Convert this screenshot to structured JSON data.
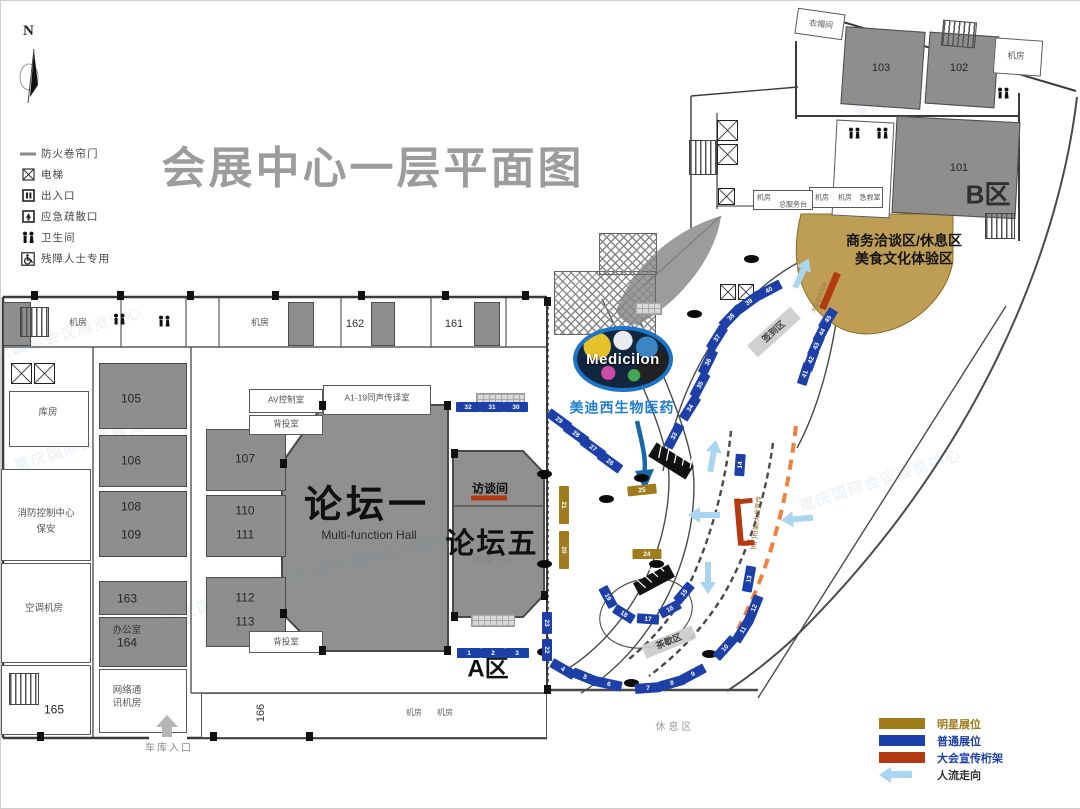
{
  "title": "会展中心一层平面图",
  "compass": {
    "label": "N"
  },
  "legend_top": {
    "items": [
      {
        "icon": "fire-shutter-icon",
        "label": "防火卷帘门"
      },
      {
        "icon": "elevator-icon",
        "label": "电梯"
      },
      {
        "icon": "entrance-icon",
        "label": "出入口"
      },
      {
        "icon": "emergency-exit-icon",
        "label": "应急疏散口"
      },
      {
        "icon": "restroom-icon",
        "label": "卫生间"
      },
      {
        "icon": "wheelchair-icon",
        "label": "残障人士专用"
      }
    ]
  },
  "legend_bottom": {
    "items": [
      {
        "type": "swatch",
        "color": "#a17c1c",
        "label": "明星展位",
        "label_color": "#a17c1c"
      },
      {
        "type": "swatch",
        "color": "#1c3fa8",
        "label": "普通展位",
        "label_color": "#1c3fa8"
      },
      {
        "type": "swatch",
        "color": "#b33a10",
        "label": "大会宣传桁架",
        "label_color": "#1c3fa8"
      },
      {
        "type": "arrow",
        "color": "#a9d5f1",
        "label": "人流走向",
        "label_color": "#333333"
      }
    ]
  },
  "halls": {
    "forum1": {
      "label": "论坛一",
      "en": "Multi-function Hall"
    },
    "forum5": {
      "label": "论坛五",
      "sub": "新闻中心"
    },
    "interview": {
      "label": "访谈间"
    },
    "zoneA": {
      "label": "A区"
    },
    "zoneB": {
      "label": "B区"
    }
  },
  "medicilon": {
    "logo": "Medicilon",
    "company": "美迪西生物医药"
  },
  "areas": {
    "business_line1": "商务洽谈区/休息区",
    "business_line2": "美食文化体验区",
    "checkin": "签到区",
    "teabreak": "茶歇区",
    "rest": "休息区",
    "garage": "车库入口",
    "truss_note": "拱门桁架/大会宣传",
    "truss_note2": "大会宣传桁架"
  },
  "watermark_text": "重庆国际会议展览中心",
  "colors": {
    "booth_normal": "#1c3fa8",
    "booth_star": "#a17c1c",
    "truss": "#b33a10",
    "flow": "#a9d5f1",
    "tan_area": "#be9d55",
    "hall_fill": "#909090",
    "title": "#9c9c9c",
    "orange_dash": "#f08040"
  },
  "labels": [
    {
      "t": "机房",
      "x": 77,
      "y": 322,
      "s": 9,
      "c": "#555"
    },
    {
      "t": "机房",
      "x": 259,
      "y": 322,
      "s": 9,
      "c": "#555"
    },
    {
      "t": "162",
      "x": 354,
      "y": 324,
      "s": 11,
      "c": "#333"
    },
    {
      "t": "161",
      "x": 453,
      "y": 324,
      "s": 11,
      "c": "#333"
    },
    {
      "t": "库房",
      "x": 47,
      "y": 412,
      "s": 9.5,
      "c": "#555"
    },
    {
      "t": "105",
      "x": 130,
      "y": 398,
      "s": 12,
      "c": "#262626"
    },
    {
      "t": "106",
      "x": 130,
      "y": 460,
      "s": 12,
      "c": "#262626"
    },
    {
      "t": "108",
      "x": 130,
      "y": 506,
      "s": 12,
      "c": "#262626"
    },
    {
      "t": "109",
      "x": 130,
      "y": 534,
      "s": 12,
      "c": "#262626"
    },
    {
      "t": "107",
      "x": 244,
      "y": 458,
      "s": 12,
      "c": "#262626"
    },
    {
      "t": "110",
      "x": 244,
      "y": 510,
      "s": 12,
      "c": "#262626"
    },
    {
      "t": "111",
      "x": 244,
      "y": 534,
      "s": 12,
      "c": "#262626"
    },
    {
      "t": "112",
      "x": 244,
      "y": 597,
      "s": 12,
      "c": "#262626"
    },
    {
      "t": "113",
      "x": 244,
      "y": 621,
      "s": 12,
      "c": "#262626"
    },
    {
      "t": "消防控制中心",
      "x": 45,
      "y": 513,
      "s": 9.5,
      "c": "#555"
    },
    {
      "t": "保安",
      "x": 45,
      "y": 529,
      "s": 9.5,
      "c": "#555"
    },
    {
      "t": "空调机房",
      "x": 43,
      "y": 608,
      "s": 9.5,
      "c": "#555"
    },
    {
      "t": "163",
      "x": 126,
      "y": 598,
      "s": 12,
      "c": "#262626"
    },
    {
      "t": "办公室",
      "x": 126,
      "y": 630,
      "s": 9.5,
      "c": "#333"
    },
    {
      "t": "164",
      "x": 126,
      "y": 642,
      "s": 12,
      "c": "#262626"
    },
    {
      "t": "网络通",
      "x": 126,
      "y": 690,
      "s": 9.5,
      "c": "#555"
    },
    {
      "t": "讯机房",
      "x": 126,
      "y": 703,
      "s": 9.5,
      "c": "#555"
    },
    {
      "t": "165",
      "x": 53,
      "y": 709,
      "s": 12,
      "c": "#262626"
    },
    {
      "t": "166",
      "x": 261,
      "y": 712,
      "s": 11,
      "c": "#333",
      "r": -90
    },
    {
      "t": "机房",
      "x": 413,
      "y": 712,
      "s": 8,
      "c": "#666"
    },
    {
      "t": "机房",
      "x": 444,
      "y": 712,
      "s": 8,
      "c": "#666"
    },
    {
      "t": "车库入口",
      "x": 168,
      "y": 748,
      "s": 10,
      "c": "#8a8a8a",
      "ls": 2,
      "n": "garage-entrance-label"
    },
    {
      "t": "AV控制室",
      "x": 285,
      "y": 399,
      "s": 8.5,
      "c": "#555"
    },
    {
      "t": "A1-19同声传译室",
      "x": 376,
      "y": 397,
      "s": 8.5,
      "c": "#555"
    },
    {
      "t": "背投室",
      "x": 285,
      "y": 423,
      "s": 8.5,
      "c": "#555"
    },
    {
      "t": "背投室",
      "x": 285,
      "y": 641,
      "s": 8.5,
      "c": "#555"
    },
    {
      "t": "衣帽间",
      "x": 820,
      "y": 24,
      "s": 8,
      "c": "#555",
      "r": 6
    },
    {
      "t": "103",
      "x": 880,
      "y": 68,
      "s": 11,
      "c": "#262626"
    },
    {
      "t": "102",
      "x": 958,
      "y": 68,
      "s": 11,
      "c": "#262626"
    },
    {
      "t": "机房",
      "x": 1015,
      "y": 55,
      "s": 8.5,
      "c": "#555"
    },
    {
      "t": "101",
      "x": 958,
      "y": 168,
      "s": 11,
      "c": "#262626"
    },
    {
      "t": "机房",
      "x": 763,
      "y": 197,
      "s": 7,
      "c": "#555"
    },
    {
      "t": "总服务台",
      "x": 792,
      "y": 204,
      "s": 7,
      "c": "#555"
    },
    {
      "t": "机房",
      "x": 821,
      "y": 197,
      "s": 7,
      "c": "#555"
    },
    {
      "t": "机房",
      "x": 844,
      "y": 197,
      "s": 7,
      "c": "#555"
    },
    {
      "t": "急救室",
      "x": 869,
      "y": 197,
      "s": 7,
      "c": "#555"
    },
    {
      "t": "休息区",
      "x": 674,
      "y": 727,
      "s": 10,
      "c": "#9a9a9a",
      "ls": 3,
      "n": "rest-area-label"
    },
    {
      "t": "签到区",
      "x": 773,
      "y": 331,
      "s": 9,
      "c": "#444",
      "r": -42,
      "b": 1,
      "n": "checkin-area-label"
    },
    {
      "t": "茶歇区",
      "x": 668,
      "y": 641,
      "s": 9,
      "c": "#444",
      "r": -22,
      "b": 1,
      "n": "teabreak-area-label"
    },
    {
      "t": "商务洽谈区/休息区",
      "x": 903,
      "y": 240,
      "s": 14,
      "c": "#141414",
      "b": 1,
      "n": "business-area-label"
    },
    {
      "t": "美食文化体验区",
      "x": 903,
      "y": 258,
      "s": 14,
      "c": "#141414",
      "b": 1,
      "n": "food-area-label"
    },
    {
      "t": "美迪西生物医药",
      "x": 621,
      "y": 407,
      "s": 14,
      "c": "#1f7ed0",
      "b": 1,
      "ls": 1,
      "n": "medicilon-company-label"
    },
    {
      "t": "拱门桁架/大会宣传",
      "x": 757,
      "y": 522,
      "s": 6.5,
      "c": "#8a5a2a",
      "r": -84,
      "n": "truss-note-label"
    },
    {
      "t": "大会宣传桁架",
      "x": 820,
      "y": 297,
      "s": 5.5,
      "c": "#997744",
      "r": -67,
      "n": "truss-note2-label"
    }
  ],
  "watermarks": [
    {
      "x": 95,
      "y": 440,
      "r": -18
    },
    {
      "x": 245,
      "y": 593,
      "r": -18
    },
    {
      "x": 400,
      "y": 551,
      "r": -12
    },
    {
      "x": 935,
      "y": 88,
      "r": -16
    },
    {
      "x": 60,
      "y": 335,
      "r": -16
    },
    {
      "x": 880,
      "y": 480,
      "r": -18
    }
  ],
  "booths": [
    {
      "n": 1,
      "x": 468,
      "y": 652,
      "r": 0,
      "t": "n",
      "w": 24
    },
    {
      "n": 2,
      "x": 492,
      "y": 652,
      "r": 0,
      "t": "n",
      "w": 24
    },
    {
      "n": 3,
      "x": 516,
      "y": 652,
      "r": 0,
      "t": "n",
      "w": 24
    },
    {
      "n": 4,
      "x": 562,
      "y": 668,
      "r": 30,
      "t": "n"
    },
    {
      "n": 5,
      "x": 584,
      "y": 676,
      "r": 22,
      "t": "n"
    },
    {
      "n": 6,
      "x": 608,
      "y": 683,
      "r": 12,
      "t": "n"
    },
    {
      "n": 7,
      "x": 647,
      "y": 687,
      "r": -4,
      "t": "n"
    },
    {
      "n": 8,
      "x": 671,
      "y": 682,
      "r": -16,
      "t": "n"
    },
    {
      "n": 9,
      "x": 692,
      "y": 673,
      "r": -28,
      "t": "n"
    },
    {
      "n": 10,
      "x": 724,
      "y": 647,
      "r": -48,
      "t": "n"
    },
    {
      "n": 11,
      "x": 742,
      "y": 629,
      "r": -58,
      "t": "n"
    },
    {
      "n": 12,
      "x": 753,
      "y": 607,
      "r": -68,
      "t": "n"
    },
    {
      "n": 13,
      "x": 748,
      "y": 578,
      "r": -80,
      "t": "n"
    },
    {
      "n": 14,
      "x": 739,
      "y": 464,
      "r": -86,
      "t": "n",
      "w": 22
    },
    {
      "n": 15,
      "x": 683,
      "y": 592,
      "r": -50,
      "t": "n",
      "w": 22
    },
    {
      "n": 16,
      "x": 669,
      "y": 608,
      "r": -28,
      "t": "n",
      "w": 22
    },
    {
      "n": 17,
      "x": 647,
      "y": 618,
      "r": 4,
      "t": "n",
      "w": 22
    },
    {
      "n": 18,
      "x": 623,
      "y": 613,
      "r": 32,
      "t": "n",
      "w": 22
    },
    {
      "n": 19,
      "x": 607,
      "y": 596,
      "r": 62,
      "t": "n",
      "w": 22
    },
    {
      "n": 20,
      "x": 563,
      "y": 549,
      "r": 90,
      "t": "s",
      "w": 38
    },
    {
      "n": 21,
      "x": 563,
      "y": 504,
      "r": 90,
      "t": "s",
      "w": 38
    },
    {
      "n": 22,
      "x": 546,
      "y": 649,
      "r": 90,
      "t": "n",
      "w": 22
    },
    {
      "n": 23,
      "x": 546,
      "y": 622,
      "r": 90,
      "t": "n",
      "w": 22
    },
    {
      "n": 24,
      "x": 646,
      "y": 553,
      "r": 0,
      "t": "s"
    },
    {
      "n": 25,
      "x": 641,
      "y": 489,
      "r": -6,
      "t": "s"
    },
    {
      "n": 26,
      "x": 609,
      "y": 461,
      "r": 36,
      "t": "n"
    },
    {
      "n": 27,
      "x": 592,
      "y": 447,
      "r": 36,
      "t": "n"
    },
    {
      "n": 28,
      "x": 575,
      "y": 433,
      "r": 36,
      "t": "n"
    },
    {
      "n": 29,
      "x": 558,
      "y": 419,
      "r": 36,
      "t": "n"
    },
    {
      "n": 30,
      "x": 515,
      "y": 406,
      "r": 0,
      "t": "n",
      "w": 24
    },
    {
      "n": 31,
      "x": 491,
      "y": 406,
      "r": 0,
      "t": "n",
      "w": 24
    },
    {
      "n": 32,
      "x": 467,
      "y": 406,
      "r": 0,
      "t": "n",
      "w": 24
    },
    {
      "n": 33,
      "x": 673,
      "y": 435,
      "r": -62,
      "t": "n"
    },
    {
      "n": 34,
      "x": 689,
      "y": 407,
      "r": -58,
      "t": "n"
    },
    {
      "n": 35,
      "x": 699,
      "y": 384,
      "r": -62,
      "t": "n"
    },
    {
      "n": 36,
      "x": 707,
      "y": 361,
      "r": -64,
      "t": "n"
    },
    {
      "n": 37,
      "x": 716,
      "y": 337,
      "r": -58,
      "t": "n"
    },
    {
      "n": 38,
      "x": 730,
      "y": 316,
      "r": -46,
      "t": "n"
    },
    {
      "n": 39,
      "x": 748,
      "y": 301,
      "r": -36,
      "t": "n"
    },
    {
      "n": 40,
      "x": 768,
      "y": 289,
      "r": -28,
      "t": "n"
    },
    {
      "n": 41,
      "x": 804,
      "y": 373,
      "r": -72,
      "t": "n",
      "w": 22
    },
    {
      "n": 42,
      "x": 810,
      "y": 359,
      "r": -70,
      "t": "n",
      "w": 22
    },
    {
      "n": 43,
      "x": 815,
      "y": 345,
      "r": -66,
      "t": "n",
      "w": 22
    },
    {
      "n": 44,
      "x": 821,
      "y": 331,
      "r": -62,
      "t": "n",
      "w": 22
    },
    {
      "n": 45,
      "x": 827,
      "y": 318,
      "r": -58,
      "t": "n",
      "w": 22
    }
  ],
  "trusses": [
    {
      "x": 829,
      "y": 290,
      "w": 39,
      "h": 7,
      "r": -67
    },
    {
      "x": 488,
      "y": 497,
      "w": 36,
      "h": 5,
      "r": 0
    },
    {
      "x": 738,
      "y": 521,
      "w": 6,
      "h": 47,
      "r": -5
    },
    {
      "x": 745,
      "y": 500,
      "w": 13,
      "h": 5,
      "r": -6
    },
    {
      "x": 747,
      "y": 542,
      "w": 13,
      "h": 5,
      "r": -4
    }
  ],
  "flow_arrows": [
    {
      "x": 801,
      "y": 272,
      "r": 115
    },
    {
      "x": 712,
      "y": 455,
      "r": 100
    },
    {
      "x": 703,
      "y": 514,
      "r": 0
    },
    {
      "x": 796,
      "y": 518,
      "r": -5
    },
    {
      "x": 707,
      "y": 577,
      "r": 270
    }
  ],
  "structures": {
    "rooms_gray": [
      [
        2,
        301,
        28,
        44
      ],
      [
        287,
        301,
        26,
        44
      ],
      [
        370,
        301,
        24,
        44
      ],
      [
        473,
        301,
        26,
        44
      ],
      [
        98,
        362,
        88,
        66
      ],
      [
        98,
        434,
        88,
        52
      ],
      [
        98,
        490,
        88,
        66
      ],
      [
        98,
        580,
        88,
        34
      ],
      [
        98,
        616,
        88,
        50
      ],
      [
        205,
        428,
        80,
        62
      ],
      [
        205,
        494,
        80,
        62
      ],
      [
        205,
        576,
        80,
        70
      ],
      [
        842,
        28,
        80,
        78,
        4
      ],
      [
        926,
        33,
        70,
        72,
        4
      ],
      [
        893,
        118,
        124,
        97,
        3
      ]
    ],
    "rooms_white": [
      [
        8,
        390,
        80,
        56
      ],
      [
        0,
        468,
        90,
        92
      ],
      [
        0,
        562,
        90,
        100
      ],
      [
        98,
        668,
        88,
        64
      ],
      [
        0,
        664,
        90,
        70
      ],
      [
        248,
        388,
        74,
        24
      ],
      [
        322,
        384,
        108,
        30
      ],
      [
        248,
        414,
        74,
        20
      ],
      [
        248,
        630,
        74,
        22
      ],
      [
        245,
        692,
        32,
        45
      ],
      [
        795,
        10,
        48,
        26,
        8
      ],
      [
        993,
        38,
        48,
        36,
        4
      ],
      [
        833,
        120,
        58,
        96,
        3
      ],
      [
        808,
        186,
        74,
        21
      ],
      [
        752,
        189,
        60,
        20
      ],
      [
        200,
        692,
        346,
        45
      ]
    ],
    "stairs": [
      [
        19,
        306,
        29,
        30
      ],
      [
        8,
        672,
        30,
        32
      ],
      [
        688,
        139,
        29,
        35
      ],
      [
        941,
        20,
        34,
        26,
        5
      ],
      [
        984,
        212,
        30,
        26
      ]
    ],
    "elevators": [
      [
        10,
        362,
        21
      ],
      [
        33,
        362,
        21
      ],
      [
        716,
        119,
        21
      ],
      [
        716,
        143,
        21
      ],
      [
        717,
        187,
        17
      ],
      [
        719,
        283,
        16
      ],
      [
        737,
        283,
        16
      ]
    ],
    "grids": [
      [
        475,
        392,
        47,
        11
      ],
      [
        470,
        613,
        42,
        11
      ],
      [
        634,
        301,
        25,
        11
      ]
    ],
    "hatches": [
      [
        553,
        270,
        100,
        62
      ],
      [
        598,
        232,
        56,
        40
      ]
    ],
    "bands": [
      [
        773,
        331,
        58,
        16,
        -42
      ],
      [
        668,
        641,
        54,
        14,
        -22
      ]
    ],
    "dots": [
      [
        543,
        473
      ],
      [
        543,
        563
      ],
      [
        543,
        651
      ],
      [
        640,
        477
      ],
      [
        655,
        563
      ],
      [
        630,
        682
      ],
      [
        708,
        653
      ],
      [
        750,
        258
      ],
      [
        693,
        313
      ],
      [
        605,
        498
      ]
    ],
    "nubs": [
      [
        30,
        290
      ],
      [
        116,
        290
      ],
      [
        186,
        290
      ],
      [
        271,
        290
      ],
      [
        357,
        290
      ],
      [
        441,
        290
      ],
      [
        521,
        290
      ],
      [
        318,
        400
      ],
      [
        443,
        400
      ],
      [
        318,
        645
      ],
      [
        443,
        645
      ],
      [
        279,
        458
      ],
      [
        279,
        608
      ],
      [
        450,
        448
      ],
      [
        450,
        611
      ],
      [
        540,
        469
      ],
      [
        540,
        590
      ],
      [
        543,
        296
      ],
      [
        543,
        684
      ],
      [
        36,
        731
      ],
      [
        209,
        731
      ],
      [
        305,
        731
      ]
    ],
    "restrooms": [
      [
        118,
        318
      ],
      [
        163,
        320
      ],
      [
        853,
        132
      ],
      [
        881,
        132
      ],
      [
        1002,
        92
      ]
    ]
  }
}
